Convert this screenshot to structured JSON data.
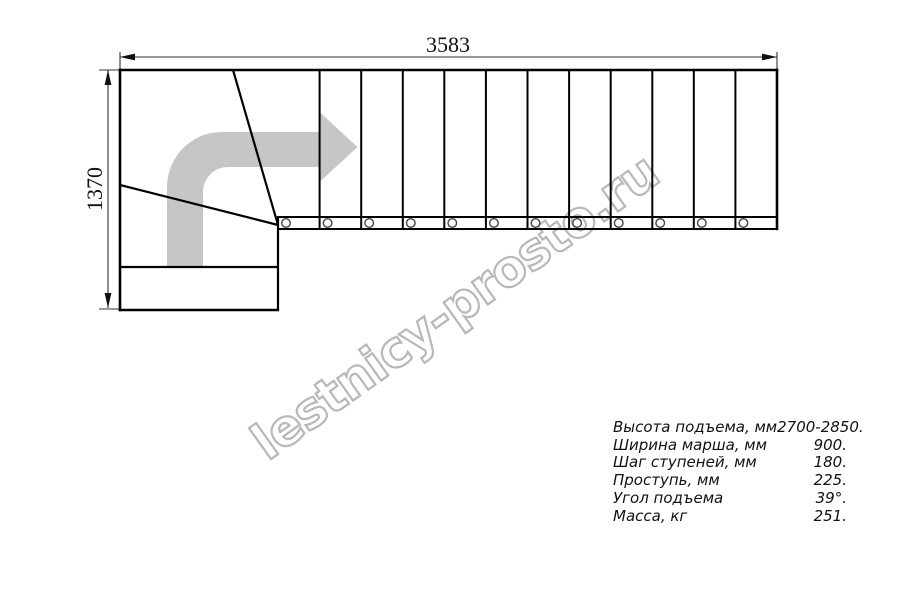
{
  "drawing": {
    "top_dimension": "3583",
    "left_dimension": "1370"
  },
  "watermark": {
    "text": "lestnicy-prosto.ru"
  },
  "specs": {
    "rows": [
      {
        "label": "Высота подъема, мм",
        "value": "2700-2850."
      },
      {
        "label": "Ширина марша, мм",
        "value": "900."
      },
      {
        "label": "Шаг ступеней, мм",
        "value": "180."
      },
      {
        "label": "Проступь, мм",
        "value": "225."
      },
      {
        "label": "Угол подъема",
        "value": "39°."
      },
      {
        "label": "Масса, кг",
        "value": "251."
      }
    ]
  },
  "colors": {
    "line": "#000000",
    "dimension_line": "#333333",
    "arrow_fill": "#c6c6c6",
    "watermark_stroke": "#b8b8b8"
  }
}
